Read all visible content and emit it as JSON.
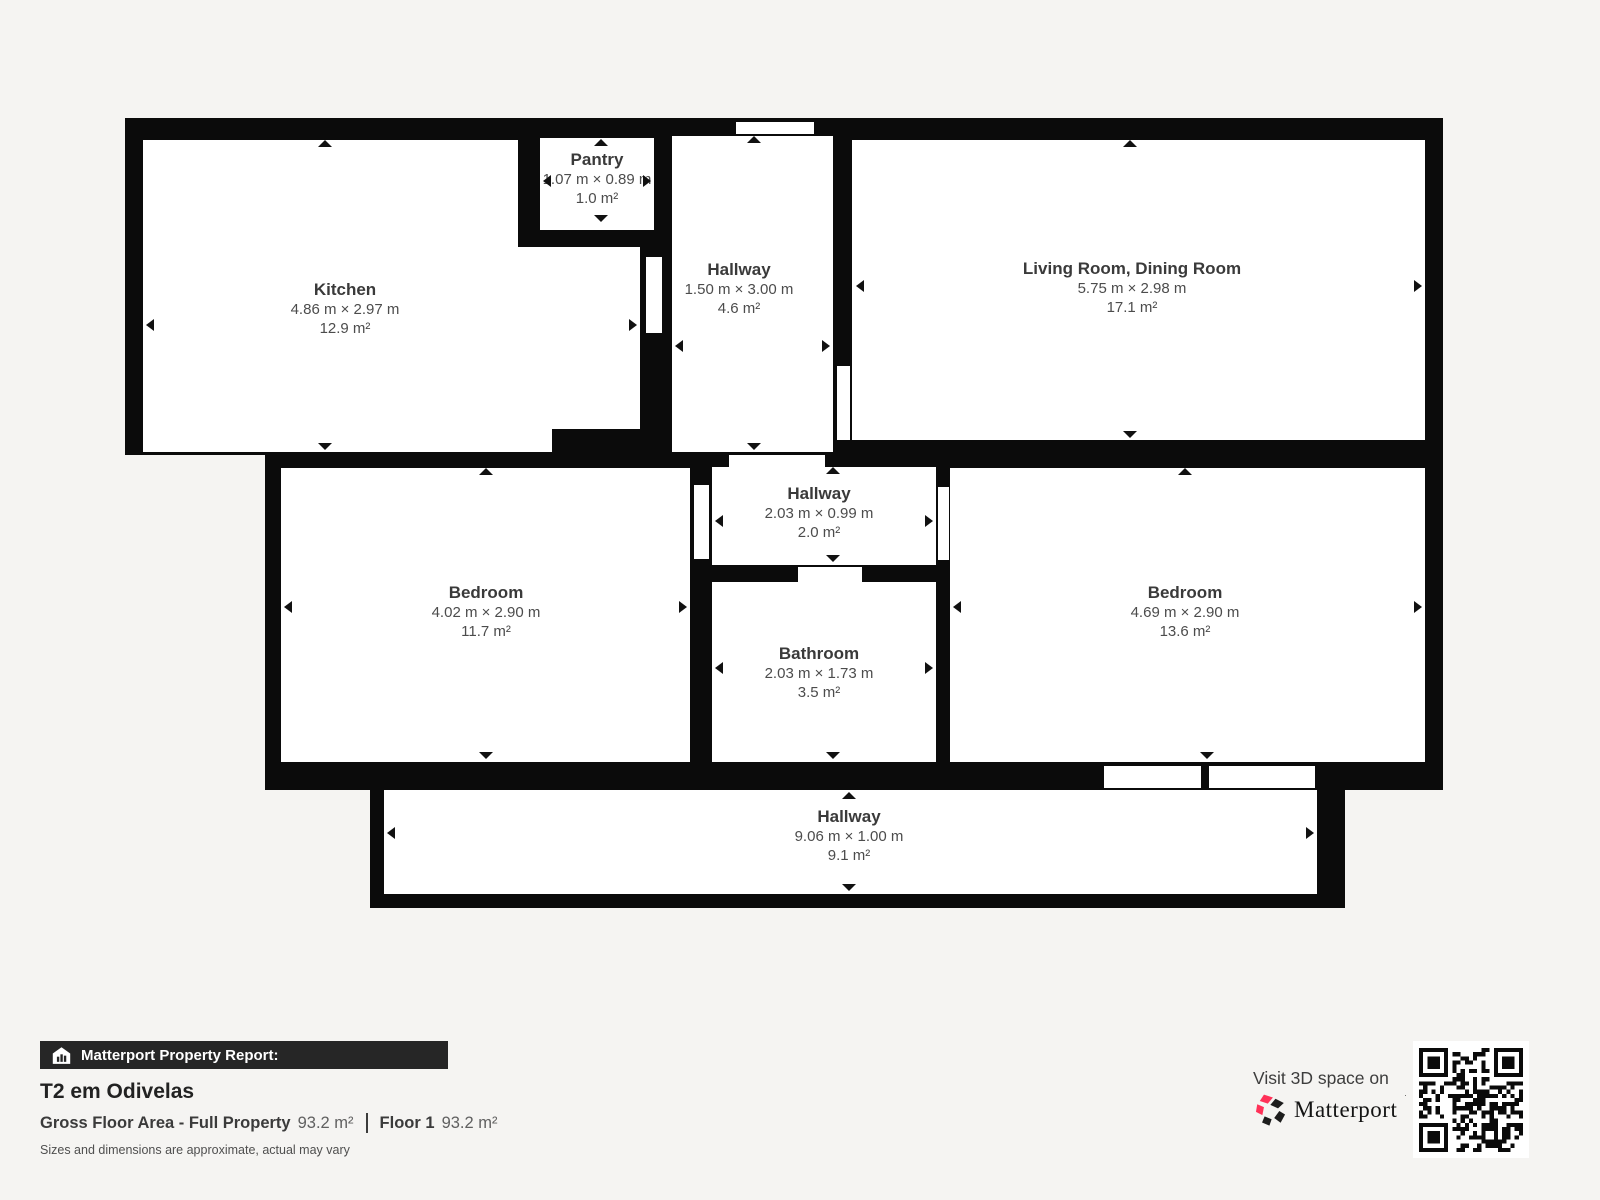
{
  "report": {
    "bar_label": "Matterport Property Report:",
    "title": "T2 em Odivelas",
    "gross_area_label": "Gross Floor Area - Full Property",
    "gross_area_value": "93.2 m²",
    "floor_label": "Floor 1",
    "floor_value": "93.2 m²",
    "disclaimer": "Sizes and dimensions are approximate, actual may vary"
  },
  "cta": {
    "text": "Visit 3D space on",
    "brand": "Matterport"
  },
  "colors": {
    "background": "#f5f4f2",
    "wall": "#0b0b0b",
    "brand_pink": "#ff3158",
    "brand_dark": "#1d1d1d"
  },
  "floor_plan": {
    "total_area": "93.2 m²",
    "rooms": [
      {
        "name": "Pantry",
        "dims": "1.07 m × 0.89 m",
        "area": "1.0 m²",
        "label": {
          "cx": 597,
          "top": 150
        },
        "arrows": [
          [
            "up",
            601,
            139
          ],
          [
            "down",
            601,
            222
          ],
          [
            "left",
            543,
            181
          ],
          [
            "right",
            651,
            181
          ]
        ]
      },
      {
        "name": "Kitchen",
        "dims": "4.86 m × 2.97 m",
        "area": "12.9 m²",
        "label": {
          "cx": 345,
          "top": 280
        },
        "arrows": [
          [
            "up",
            325,
            140
          ],
          [
            "down",
            325,
            450
          ],
          [
            "left",
            146,
            325
          ],
          [
            "right",
            637,
            325
          ]
        ]
      },
      {
        "name": "Hallway",
        "dims": "1.50 m × 3.00 m",
        "area": "4.6 m²",
        "label": {
          "cx": 739,
          "top": 260
        },
        "arrows": [
          [
            "up",
            754,
            136
          ],
          [
            "down",
            754,
            450
          ],
          [
            "left",
            675,
            346
          ],
          [
            "right",
            830,
            346
          ]
        ]
      },
      {
        "name": "Living Room, Dining Room",
        "dims": "5.75 m × 2.98 m",
        "area": "17.1 m²",
        "label": {
          "cx": 1132,
          "top": 259
        },
        "arrows": [
          [
            "up",
            1130,
            140
          ],
          [
            "down",
            1130,
            438
          ],
          [
            "left",
            856,
            286
          ],
          [
            "right",
            1422,
            286
          ]
        ]
      },
      {
        "name": "Hallway",
        "dims": "2.03 m × 0.99 m",
        "area": "2.0 m²",
        "label": {
          "cx": 819,
          "top": 484
        },
        "arrows": [
          [
            "up",
            833,
            467
          ],
          [
            "down",
            833,
            562
          ],
          [
            "left",
            715,
            521
          ],
          [
            "right",
            933,
            521
          ]
        ]
      },
      {
        "name": "Bedroom",
        "dims": "4.02 m × 2.90 m",
        "area": "11.7 m²",
        "label": {
          "cx": 486,
          "top": 583
        },
        "arrows": [
          [
            "up",
            486,
            468
          ],
          [
            "down",
            486,
            759
          ],
          [
            "left",
            284,
            607
          ],
          [
            "right",
            687,
            607
          ]
        ]
      },
      {
        "name": "Bathroom",
        "dims": "2.03 m × 1.73 m",
        "area": "3.5 m²",
        "label": {
          "cx": 819,
          "top": 644
        },
        "arrows": [
          [
            "down",
            833,
            759
          ],
          [
            "left",
            715,
            668
          ],
          [
            "right",
            933,
            668
          ]
        ]
      },
      {
        "name": "Bedroom",
        "dims": "4.69 m × 2.90 m",
        "area": "13.6 m²",
        "label": {
          "cx": 1185,
          "top": 583
        },
        "arrows": [
          [
            "up",
            1185,
            468
          ],
          [
            "down",
            1207,
            759
          ],
          [
            "left",
            953,
            607
          ],
          [
            "right",
            1422,
            607
          ]
        ]
      },
      {
        "name": "Hallway",
        "dims": "9.06 m × 1.00 m",
        "area": "9.1 m²",
        "label": {
          "cx": 849,
          "top": 807
        },
        "arrows": [
          [
            "up",
            849,
            792
          ],
          [
            "down",
            849,
            891
          ],
          [
            "left",
            387,
            833
          ],
          [
            "right",
            1314,
            833
          ]
        ]
      }
    ]
  }
}
